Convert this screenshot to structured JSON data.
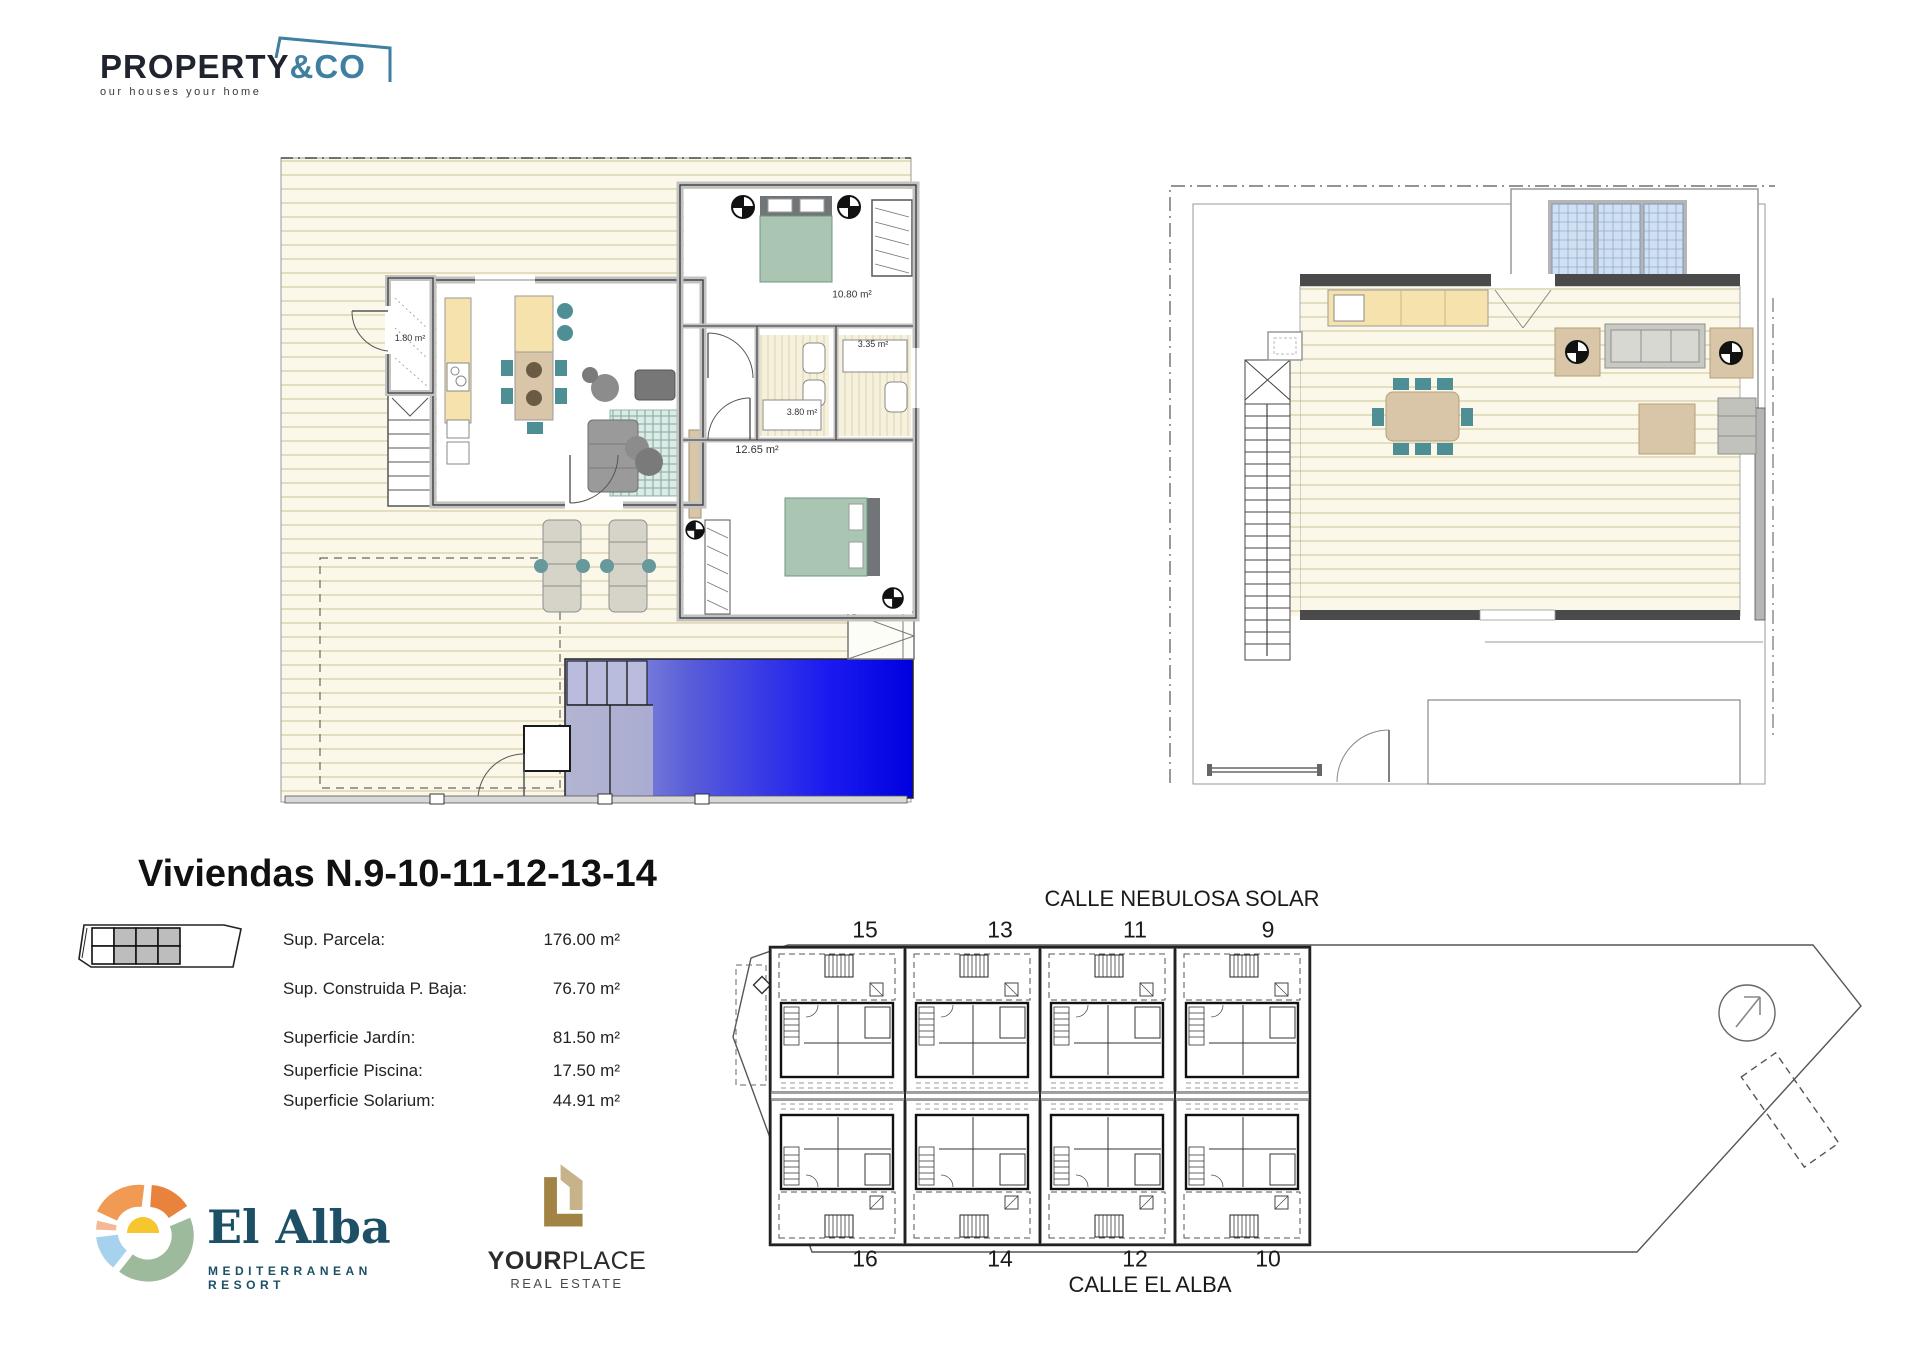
{
  "brand": {
    "primary": "PROPERTY",
    "secondary": "&CO",
    "tagline": "our houses your home",
    "accent": "#3f7fa0"
  },
  "title": "Viviendas N.9-10-11-12-13-14",
  "stats": {
    "rows": [
      {
        "label": "Sup. Parcela:",
        "value": "176.00 m²"
      },
      {
        "label": "Sup. Construida P. Baja:",
        "value": "76.70 m²"
      },
      {
        "label": "Superficie Jardín:",
        "value": "81.50 m²"
      },
      {
        "label": "Superficie Piscina:",
        "value": "17.50 m²"
      },
      {
        "label": "Superficie Solarium:",
        "value": "44.91 m²"
      }
    ]
  },
  "plans": {
    "ground": {
      "labels": {
        "storage": "1.80 m²",
        "bedroom_top": "10.80 m²",
        "bath_small": "3.35 m²",
        "bath_large": "3.80 m²",
        "bedroom_main": "12.65 m²"
      }
    }
  },
  "site": {
    "street_top": "CALLE NEBULOSA SOLAR",
    "street_bottom": "CALLE EL ALBA",
    "plots_top": [
      "15",
      "13",
      "11",
      "9"
    ],
    "plots_bottom": [
      "16",
      "14",
      "12",
      "10"
    ]
  },
  "logos": {
    "el_alba": {
      "name": "El Alba",
      "subtitle": "MEDITERRANEAN RESORT"
    },
    "your_place": {
      "bold": "YOUR",
      "light": "PLACE",
      "subtitle": "REAL ESTATE"
    }
  },
  "colors": {
    "deck": "#fbf8ea",
    "deck_stripe": "#ded8b6",
    "wall_gray": "#c2c2c2",
    "kitchen_yellow": "#f6e2ad",
    "tan": "#d9c6a8",
    "teal": "#4e8f96",
    "bed_green": "#aac6b3",
    "pool_deep": "#0000e0",
    "skylight": "#cfe0f2"
  }
}
